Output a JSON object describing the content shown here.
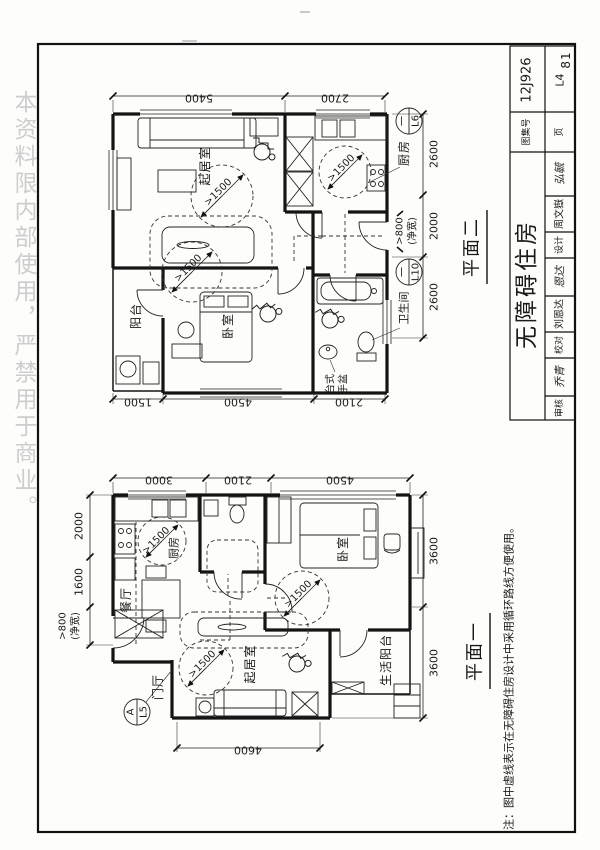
{
  "watermark": "本资料限内部使用，严禁用于商业。",
  "page_number": "81",
  "title_block": {
    "atlas_label": "图集号",
    "atlas_no": "12J926",
    "page_label": "页",
    "page_code": "L4",
    "title": "无障碍住房",
    "design_label": "设计",
    "design_name": "周文嶽",
    "design_sig": "弘毓",
    "check_label": "校对",
    "check_name": "刘恩达",
    "check_sig": "恩达",
    "review_label": "审核",
    "review_sig": "乔青"
  },
  "note": "注：图中虚线表示在无障碍住房设计中采用循环路线方便使用。",
  "shared": {
    "turning": ">1500",
    "clear": ">800",
    "clear_net": "(净宽)",
    "marker_dash": "一"
  },
  "plan2": {
    "title": "平面二",
    "dims": {
      "top1": "5400",
      "top2": "2700",
      "right1": "2600",
      "right2": "2000",
      "right3": "2600",
      "bottom1": "1500",
      "bottom2": "4500",
      "bottom3": "2100"
    },
    "rooms": {
      "living": "起居室",
      "kitchen": "厨房",
      "bedroom": "卧室",
      "balcony": "阳台",
      "bath": "卫生间"
    },
    "basin_line1": "台式",
    "basin_line2": "手盆",
    "marker_kitchen": "L6",
    "marker_bath": "L10"
  },
  "plan1": {
    "title": "平面一",
    "dims": {
      "top1": "3000",
      "top2": "2100",
      "top3": "4500",
      "left1": "2000",
      "left2": "1600",
      "right1": "3600",
      "right2": "3600",
      "bottom1": "4600"
    },
    "rooms": {
      "kitchen": "厨房",
      "dining": "餐厅",
      "foyer": "门厅",
      "bedroom": "卧室",
      "living": "起居室",
      "balcony": "生活阳台"
    },
    "marker_a": "A",
    "marker_code": "L5"
  }
}
